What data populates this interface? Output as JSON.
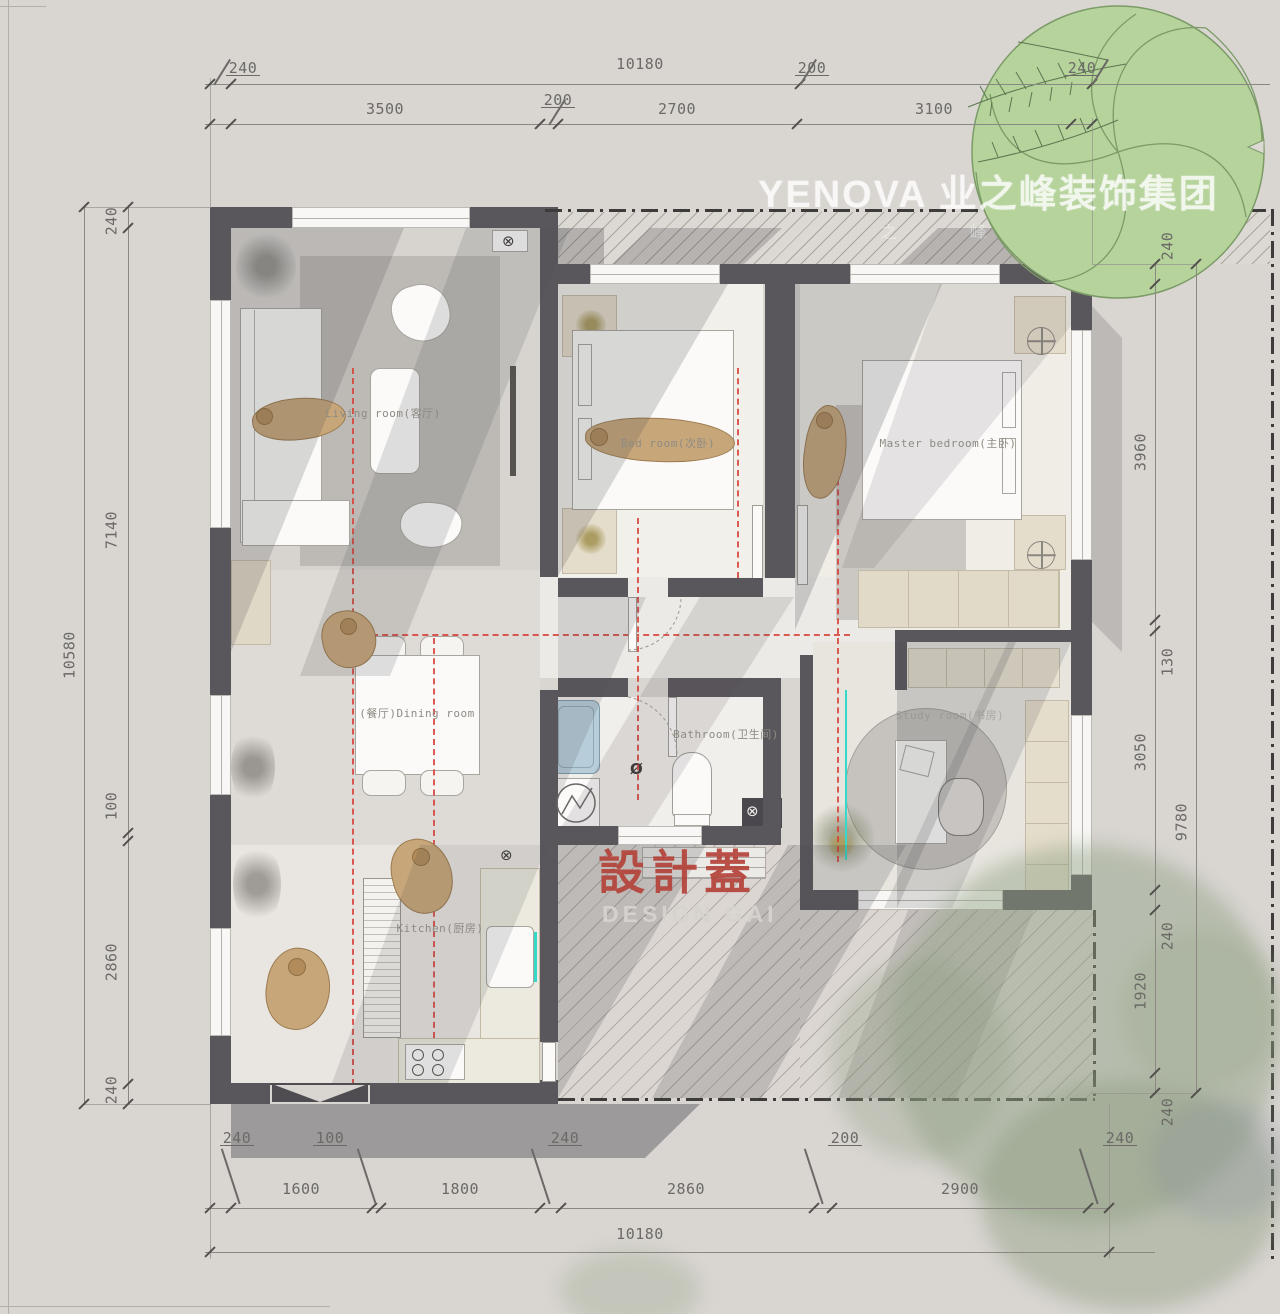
{
  "watermark": {
    "brand": "YENOVA 业之峰装饰集团",
    "slogan": "之 峰"
  },
  "stamp": {
    "title_cn": "設計蓋",
    "title_en": "DESIGN GAI"
  },
  "rooms": {
    "living": "Living room(客厅)",
    "bedroom": "Bed room(次卧)",
    "master": "Master bedroom(主卧)",
    "dining": "(餐厅)Dining room",
    "bathroom": "Bathroom(卫生间)",
    "kitchen": "Kitchen(厨房)",
    "study": "Study room(书房)"
  },
  "dimensions": {
    "top_outer": [
      "240",
      "10180",
      "200",
      "240"
    ],
    "top_inner": [
      "3500",
      "200",
      "2700",
      "3100"
    ],
    "left_outer": [
      "10580"
    ],
    "left_inner": [
      "240",
      "7140",
      "100",
      "2860",
      "240"
    ],
    "right_inner": [
      "240",
      "3960",
      "130",
      "3050",
      "240",
      "1920",
      "240"
    ],
    "right_outer": [
      "9780"
    ],
    "bottom_small": [
      "240",
      "100",
      "240",
      "200",
      "240"
    ],
    "bottom_inner": [
      "1600",
      "1800",
      "2860",
      "2900"
    ],
    "bottom_outer": [
      "10180"
    ]
  },
  "colors": {
    "wall": "#5a575c",
    "red_line": "#d84038",
    "teal_line": "#35d9c9",
    "stamp_red": "#b4423a",
    "tree_green": "#b6d39c"
  }
}
